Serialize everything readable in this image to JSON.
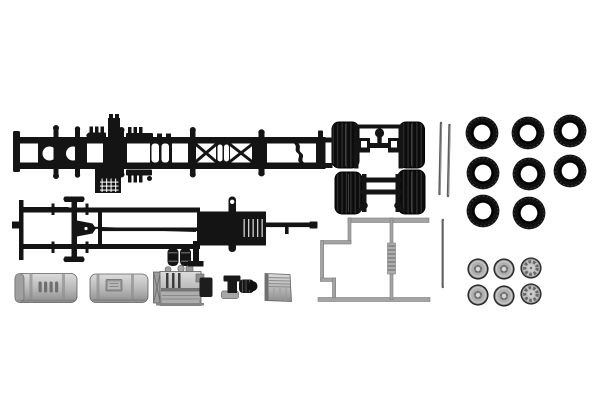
{
  "scene": {
    "description": "Product photo of an HO-scale model truck chassis plastic kit: two black chassis frames, two tandem twin-tyre axle units, eight loose black tyres, six silver wheel rims, silver fuel tanks, engine block, coupling and battery box, a light gray sprue frame and three metal axle rods on a plain white background.",
    "background": "#ffffff"
  },
  "colors": {
    "background": "#ffffff",
    "plastic_black": "#141414",
    "tire_black": "#101010",
    "silver_light": "#dcdcdc",
    "silver_mid": "#b4b4b4",
    "silver_dark": "#8d8d8d",
    "sprue_gray": "#a4a4a4",
    "rod_gray": "#5e5e5e",
    "rod_light": "#9e9e9e"
  },
  "parts": {
    "chassis_frame_top": {
      "label": "chassis ladder frame, top view",
      "quantity": 1,
      "color": "#141414"
    },
    "chassis_frame_bottom": {
      "label": "chassis underside with front axle, steering, driveshaft and gearbox",
      "quantity": 1,
      "color": "#141414"
    },
    "tandem_axle_units": {
      "label": "rear axle units with twin tyres",
      "quantity": 2,
      "color": "#141414"
    },
    "air_tanks": {
      "label": "small air reservoir cylinders",
      "quantity": 2,
      "color": "#141414"
    },
    "trailer_frame_sprue": {
      "label": "angular sprue frame",
      "quantity": 1,
      "color": "#a4a4a4"
    },
    "fuel_tank_ribbed": {
      "label": "fuel tank with ribbed panel",
      "quantity": 1,
      "color": "#b4b4b4"
    },
    "fuel_tank_plain": {
      "label": "fuel tank with filler panel",
      "quantity": 1,
      "color": "#b4b4b4"
    },
    "engine_block": {
      "label": "engine and transmission block",
      "quantity": 1,
      "color": "#b4b4b4"
    },
    "exhaust_coupling": {
      "label": "coupling / exhaust part",
      "quantity": 1,
      "color": "#141414"
    },
    "battery_box": {
      "label": "battery box",
      "quantity": 1,
      "color": "#b4b4b4"
    }
  },
  "tires": {
    "label": "loose tyres",
    "count": 8,
    "outer_r": 16.4,
    "hole_r": 8.3,
    "positions": [
      {
        "x": 482,
        "y": 133
      },
      {
        "x": 528,
        "y": 133
      },
      {
        "x": 570,
        "y": 131
      },
      {
        "x": 483,
        "y": 173
      },
      {
        "x": 529,
        "y": 174
      },
      {
        "x": 570,
        "y": 171
      },
      {
        "x": 483,
        "y": 211
      },
      {
        "x": 529,
        "y": 213
      }
    ]
  },
  "wheels": {
    "label": "silver wheel rims",
    "count": 6,
    "rim_r": 10.6,
    "positions": [
      {
        "x": 478,
        "y": 269,
        "hub": "plain"
      },
      {
        "x": 504,
        "y": 269,
        "hub": "plain"
      },
      {
        "x": 531,
        "y": 268,
        "hub": "toothed"
      },
      {
        "x": 478,
        "y": 295,
        "hub": "plain"
      },
      {
        "x": 504,
        "y": 296,
        "hub": "plain"
      },
      {
        "x": 531,
        "y": 294,
        "hub": "toothed"
      }
    ]
  },
  "rods": {
    "label": "metal axle rods",
    "count": 3,
    "segments": [
      {
        "x1": 441.0,
        "y1": 123,
        "x2": 439.5,
        "y2": 194
      },
      {
        "x1": 449.5,
        "y1": 125,
        "x2": 448.0,
        "y2": 196
      },
      {
        "x1": 442.8,
        "y1": 220,
        "x2": 442.8,
        "y2": 287
      }
    ]
  }
}
